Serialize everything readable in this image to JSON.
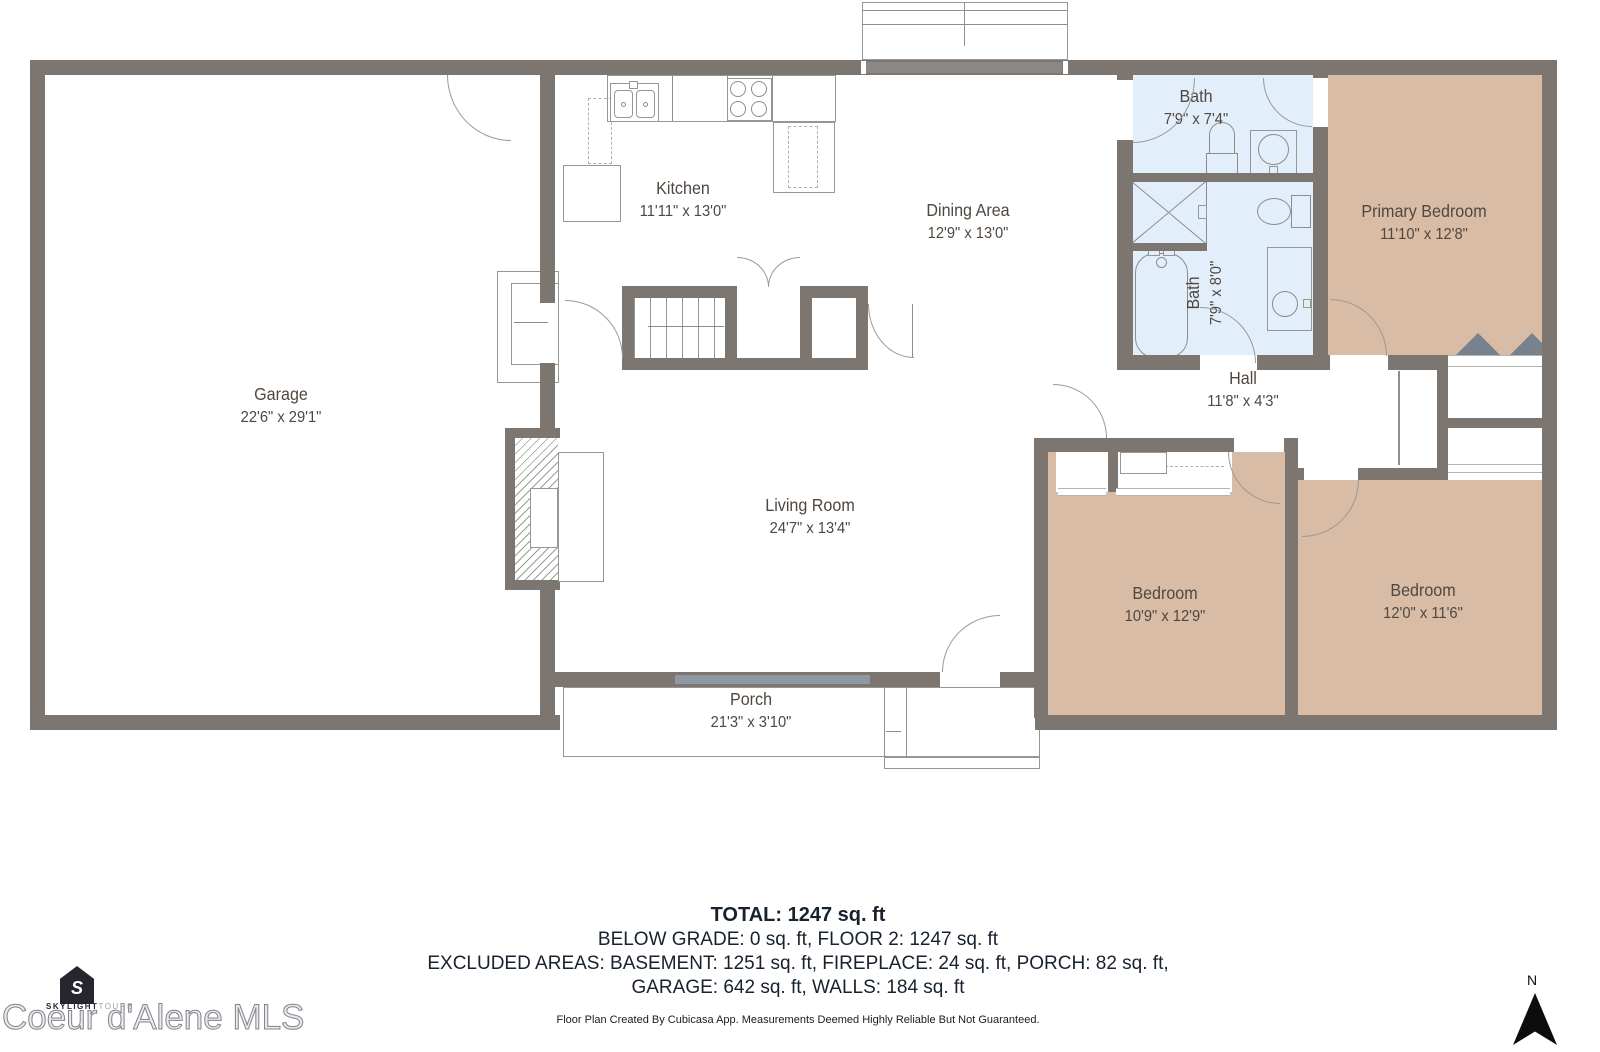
{
  "rooms": [
    {
      "name": "Garage",
      "dims": "22'6\" x 29'1\""
    },
    {
      "name": "Kitchen",
      "dims": "11'11\" x 13'0\""
    },
    {
      "name": "Dining Area",
      "dims": "12'9\" x 13'0\""
    },
    {
      "name": "Bath",
      "dims": "7'9\" x 7'4\""
    },
    {
      "name": "Bath",
      "dims": "7'9\" x 8'0\""
    },
    {
      "name": "Primary Bedroom",
      "dims": "11'10\" x 12'8\""
    },
    {
      "name": "Hall",
      "dims": "11'8\" x 4'3\""
    },
    {
      "name": "Living Room",
      "dims": "24'7\" x 13'4\""
    },
    {
      "name": "Porch",
      "dims": "21'3\" x 3'10\""
    },
    {
      "name": "Bedroom",
      "dims": "10'9\" x 12'9\""
    },
    {
      "name": "Bedroom",
      "dims": "12'0\" x 11'6\""
    }
  ],
  "summary": {
    "total": "TOTAL: 1247 sq. ft",
    "below_grade": "BELOW GRADE: 0 sq. ft, FLOOR 2: 1247 sq. ft",
    "excluded": "EXCLUDED AREAS: BASEMENT: 1251 sq. ft, FIREPLACE: 24 sq. ft, PORCH: 82 sq. ft,",
    "excluded2": "GARAGE: 642 sq. ft, WALLS: 184 sq. ft"
  },
  "footer": {
    "disclaimer": "Floor Plan Created By Cubicasa App. Measurements Deemed Highly Reliable But Not Guaranteed."
  },
  "logo": {
    "brand_bold": "SKYLIGHT",
    "brand_light": "TOURS",
    "watermark": "Coeur d'Alene MLS",
    "icon_letter": "S"
  },
  "compass": {
    "north_label": "N"
  },
  "colors": {
    "wall": "#7c7570",
    "bathroom_floor": "#e2eefa",
    "bedroom_floor": "#d8bca6",
    "window": "#8f99a3",
    "label_text": "#4f4740",
    "summary_text": "#17222e"
  },
  "icons": {
    "marker_up": "▲",
    "marker_down": "▼",
    "marker_left": "◀",
    "marker_right": "▶",
    "arrow_right_open": "▷",
    "arrow_left_open": "◁",
    "arrow_down_open": "▽"
  }
}
